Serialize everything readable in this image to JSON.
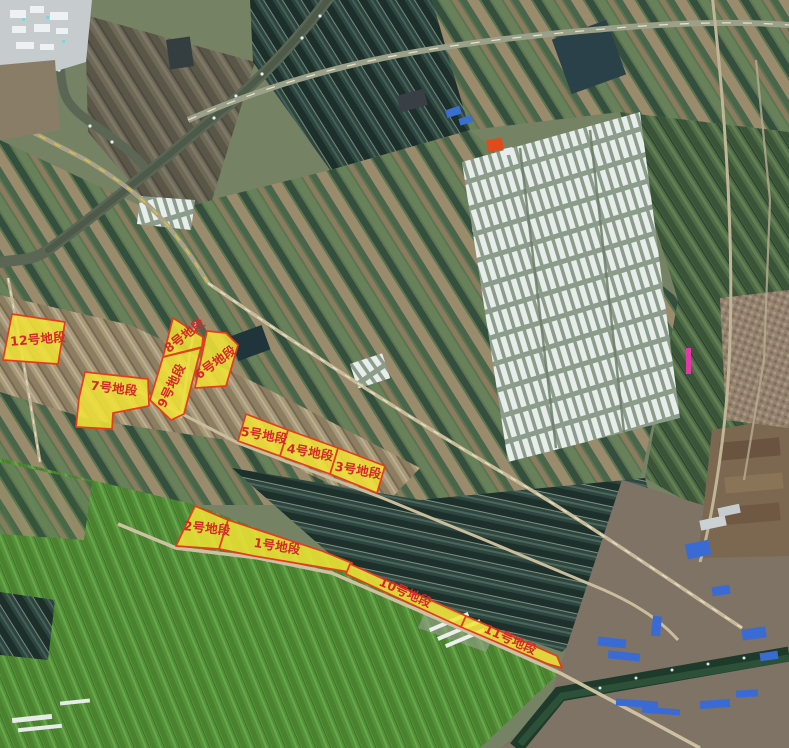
{
  "map": {
    "description": "satellite-imagery-with-land-parcel-overlays",
    "canvas": {
      "width": 789,
      "height": 748
    },
    "style": {
      "parcel_fill": "#f2e435",
      "parcel_stroke": "#e63c1e",
      "label_color": "#d6272b"
    },
    "parcels": [
      {
        "id": "parcel-1",
        "label": "1号地段",
        "points": "228,520 322,551 352,563 349,572 254,556 219,549",
        "label_x": 277,
        "label_y": 547,
        "label_rotation": 9
      },
      {
        "id": "parcel-2",
        "label": "2号地段",
        "points": "195,506 228,520 219,549 176,546",
        "label_x": 207,
        "label_y": 529,
        "label_rotation": 6
      },
      {
        "id": "parcel-3",
        "label": "3号地段",
        "points": "338,448 385,466 377,493 330,474",
        "label_x": 358,
        "label_y": 471,
        "label_rotation": 10
      },
      {
        "id": "parcel-4",
        "label": "4号地段",
        "points": "288,430 338,448 330,474 280,456",
        "label_x": 310,
        "label_y": 453,
        "label_rotation": 10
      },
      {
        "id": "parcel-5",
        "label": "5号地段",
        "points": "246,414 288,430 280,456 238,441",
        "label_x": 264,
        "label_y": 436,
        "label_rotation": 10
      },
      {
        "id": "parcel-6",
        "label": "6号地段",
        "points": "207,331 226,333 238,345 226,386 195,388",
        "label_x": 216,
        "label_y": 363,
        "label_rotation": -36
      },
      {
        "id": "parcel-7",
        "label": "7号地段",
        "points": "85,372 148,379 149,406 113,413 112,429 76,427 79,398",
        "label_x": 114,
        "label_y": 389,
        "label_rotation": 7
      },
      {
        "id": "parcel-8",
        "label": "8号地段",
        "points": "173,318 203,337 202,347 163,357",
        "label_x": 185,
        "label_y": 336,
        "label_rotation": -38
      },
      {
        "id": "parcel-9",
        "label": "9号地段",
        "points": "163,357 201,348 184,414 171,420 150,400",
        "label_x": 172,
        "label_y": 386,
        "label_rotation": -64
      },
      {
        "id": "parcel-10",
        "label": "10号地段",
        "points": "350,564 466,616 461,627 346,574",
        "label_x": 405,
        "label_y": 593,
        "label_rotation": 24
      },
      {
        "id": "parcel-11",
        "label": "11号地段",
        "points": "466,616 557,656 562,668 548,664 461,627",
        "label_x": 510,
        "label_y": 640,
        "label_rotation": 24
      },
      {
        "id": "parcel-12",
        "label": "12号地段",
        "points": "12,314 65,322 58,364 3,360",
        "label_x": 38,
        "label_y": 340,
        "label_rotation": -5
      }
    ]
  }
}
